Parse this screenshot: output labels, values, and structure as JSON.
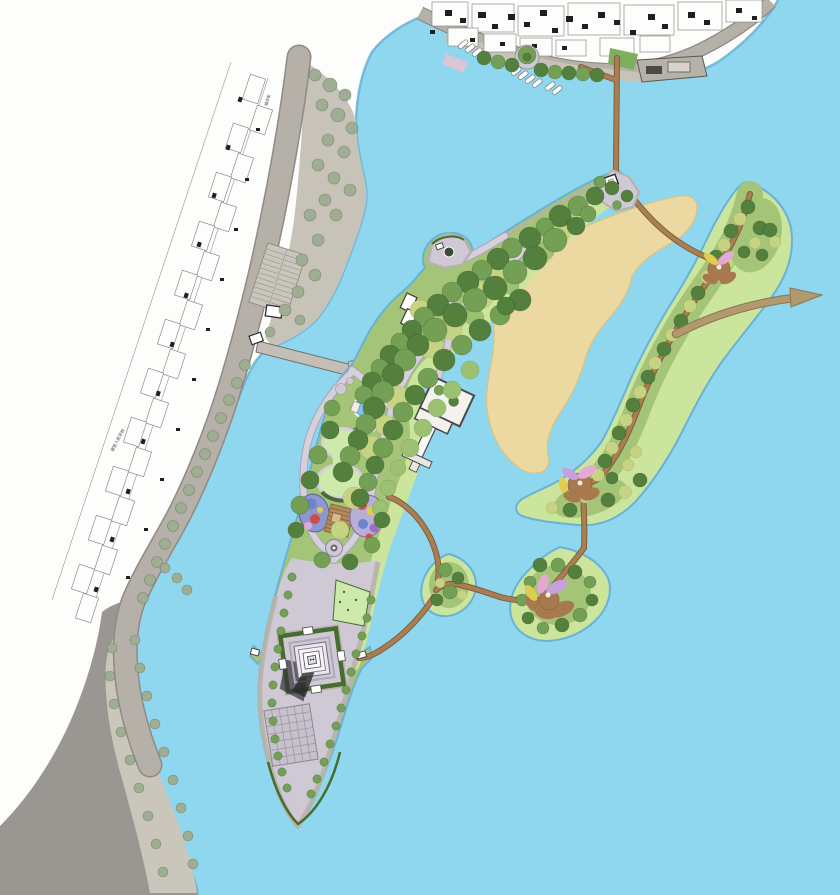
{
  "map": {
    "type": "landscape-masterplan-site-plan",
    "labels": {
      "school": "谢家人民学校",
      "street": "福泽街"
    },
    "features": {
      "water-river": "light blue river surrounding islands",
      "urban-blocks": "white cadastral building blocks with black roofs along shore roads",
      "riverside-road": "gray road band along west and north shores",
      "parking-lot": "striped parking lot on west embankment",
      "west-footbridge": "gray footbridge from west shore to main island",
      "north-footbridge": "brown footbridge from north quay to island tip",
      "ferry-dock": "gray dock platform on north shore",
      "moored-boats": "three groups of small white boats",
      "waterfront-promenade": "tree-lined promenade with round tree plaza",
      "main-park-island": "long wooded park island with winding paths",
      "sand-shoal": "tan sandbar between main island and lotus island",
      "lotus-pond-pavilion": "small blue pond with dark round pavilion",
      "lawn-amphitheater": "gourd-shaped lawn ringed by path",
      "children-playground": "two colorful play blobs with timber deck",
      "walled-garden-courtyard": "white walled courtyard with corridor and jetty",
      "north-gate-plaza": "pentagon plaza with white gate house at island tip",
      "pagoda-courtyard": "square hedge courtyard with stepped pagoda and cast shadow",
      "grid-grove-plaza": "gridded planting plaza on south esplanade",
      "south-esplanade": "lavender paved esplanade with tree rows to rounded tip",
      "lotus-island-long": "S-shaped island with trail and lotus flowers",
      "lotus-island-middle": "round islet with large lotus flower",
      "lotus-island-teardrop": "small wooded islet",
      "trail-network": "brown trails linking islands",
      "flow-arrow": "tan arrow pointing off the right edge"
    }
  },
  "colors": {
    "water": "#8ed7ef",
    "shore-shadow": "#69b2d6",
    "sand": "#ecd9a2",
    "sand-edge": "#d8c382",
    "mainland": "#fdfdfb",
    "road": "#b5b1a9",
    "road-edge": "#8f8b84",
    "embankment": "#c8c3b9",
    "land-dark": "#9a9792",
    "quay": "#cbc6bc",
    "parcel-line": "#8c8c8c",
    "building-black": "#1f1f1f",
    "tree-sage": "#9fad92",
    "canopy-dark": "#54803e",
    "canopy-mid": "#74a055",
    "canopy-light": "#9dc172",
    "canopy-yellow": "#c6d382",
    "island-base": "#a4c478",
    "marsh": "#cbe69c",
    "hedge": "#476c30",
    "plaza": "#cfc9d5",
    "plaza-pink": "#d9c6d6",
    "path": "#d6d0dd",
    "path-edge": "#aaa2b6",
    "route": "#a87e52",
    "route-dark": "#7c5a36",
    "pond": "#7cc4e4",
    "lawn": "#cdeaaa",
    "dock-lawn": "#7fae5e",
    "pg-left-base": "#8e97cf",
    "pg-right-base": "#b9aed8",
    "pg-blue": "#6b84cc",
    "pg-red": "#cc4f46",
    "pg-purple": "#9b6fc0",
    "pg-deck": "#b28b5c",
    "lotus-pink": "#e3a9d4",
    "lotus-yellow": "#e2cc50",
    "lotus-purple": "#c79fdc",
    "lotus-pad": "#a8794f",
    "wall-gray": "#b7b2a9",
    "shadow": "#333338",
    "arrow": "#b39a6e",
    "arrow-edge": "#8a7450",
    "label": "#444444",
    "white": "#ffffff"
  }
}
